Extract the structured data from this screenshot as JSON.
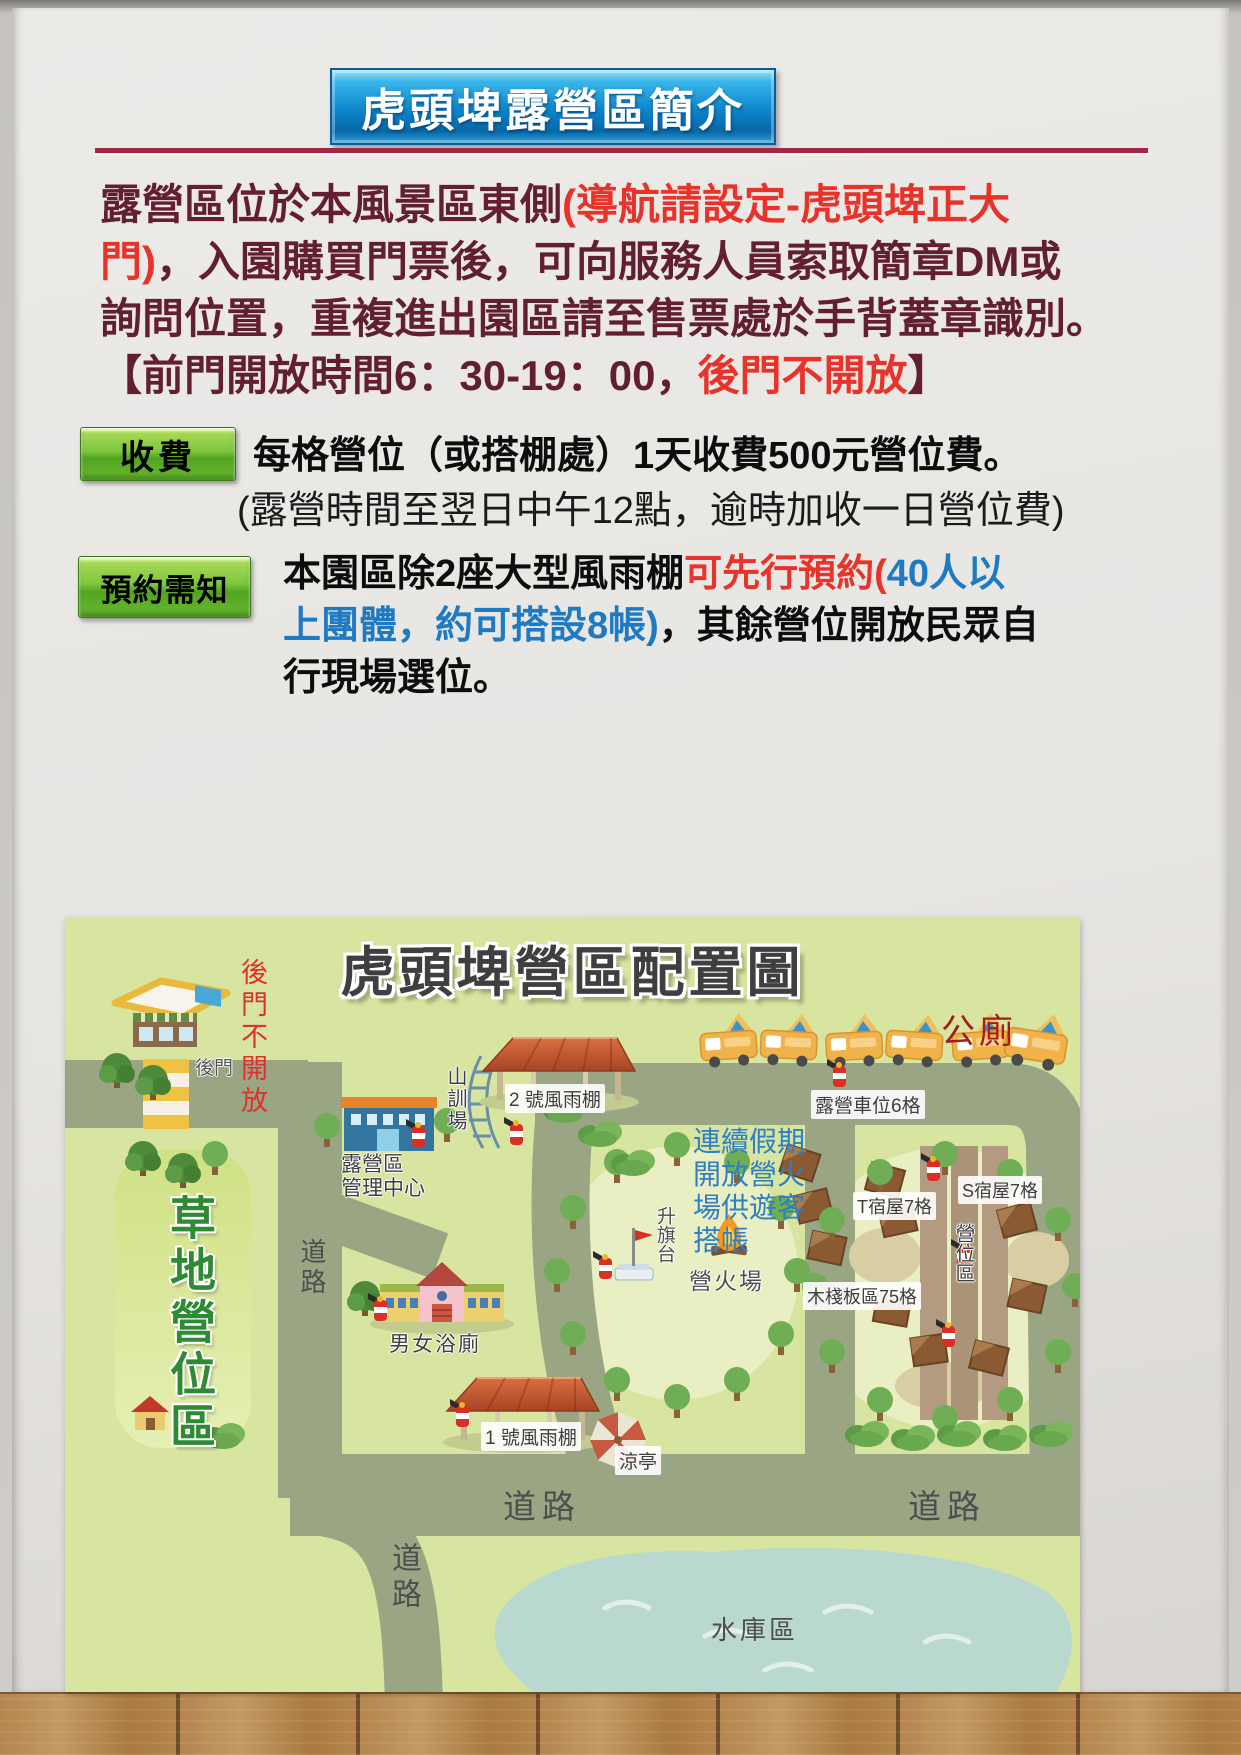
{
  "banner": {
    "title": "虎頭埤露營區簡介"
  },
  "intro": {
    "l1_dark": "露營區位於本風景區東側",
    "l1_red": "(導航請設定-虎頭埤正大",
    "l2_red": "門)",
    "l2_dark": "，入園購買門票後，可向服務人員索取簡章DM或",
    "l3": "詢問位置，重複進出園區請至售票處於手背蓋章識別。",
    "l4_pre": "【前門開放時間6：30-19：00，",
    "l4_red": "後門不開放",
    "l4_post": "】"
  },
  "fee": {
    "badge": "收費",
    "line1": "每格營位（或搭棚處）1天收費500元營位費。",
    "line2": "(露營時間至翌日中午12點，逾時加收一日營位費)"
  },
  "reservation": {
    "badge": "預約需知",
    "l1_black": "本園區除2座大型風雨棚",
    "l1_red": "可先行預約(",
    "l1_blue": "40人以",
    "l2_blue": "上團體，約可搭設8帳)",
    "l2_black": "，其餘營位開放民眾自",
    "l3": "行現場選位。"
  },
  "map": {
    "title": "虎頭埤營區配置圖",
    "labels": {
      "back_gate": "後門",
      "back_gate_closed": "後門不開放",
      "mgmt_l1": "露營區",
      "mgmt_l2": "管理中心",
      "training": "山訓場",
      "shelter2": "2 號風雨棚",
      "grass": "草地營位區",
      "road": "道路",
      "camper_spots": "露營車位6格",
      "toilet": "公廁",
      "note_l1": "連續假期",
      "note_l2": "開放營火",
      "note_l3": "場供遊客",
      "note_l4": "搭帳",
      "flag": "升旗台",
      "campfire": "營火場",
      "t_cabin": "T宿屋7格",
      "s_cabin": "S宿屋7格",
      "site_area": "營位區",
      "plank": "木棧板區75格",
      "bath": "男女浴廁",
      "shelter1": "1 號風雨棚",
      "pavilion": "涼亭",
      "reservoir": "水庫區"
    }
  },
  "colors": {
    "banner_blue": "#0c85cb",
    "maroon_text": "#621f30",
    "accent_red": "#e8332a",
    "link_blue": "#1f7ac4",
    "badge_green": "#7dc63e",
    "map_bg": "#d8e5a0",
    "road_gray_green": "#9aa584",
    "water": "#b9d8d0",
    "toilet_red": "#a11d22",
    "grass_text_green": "#2f8b33"
  }
}
